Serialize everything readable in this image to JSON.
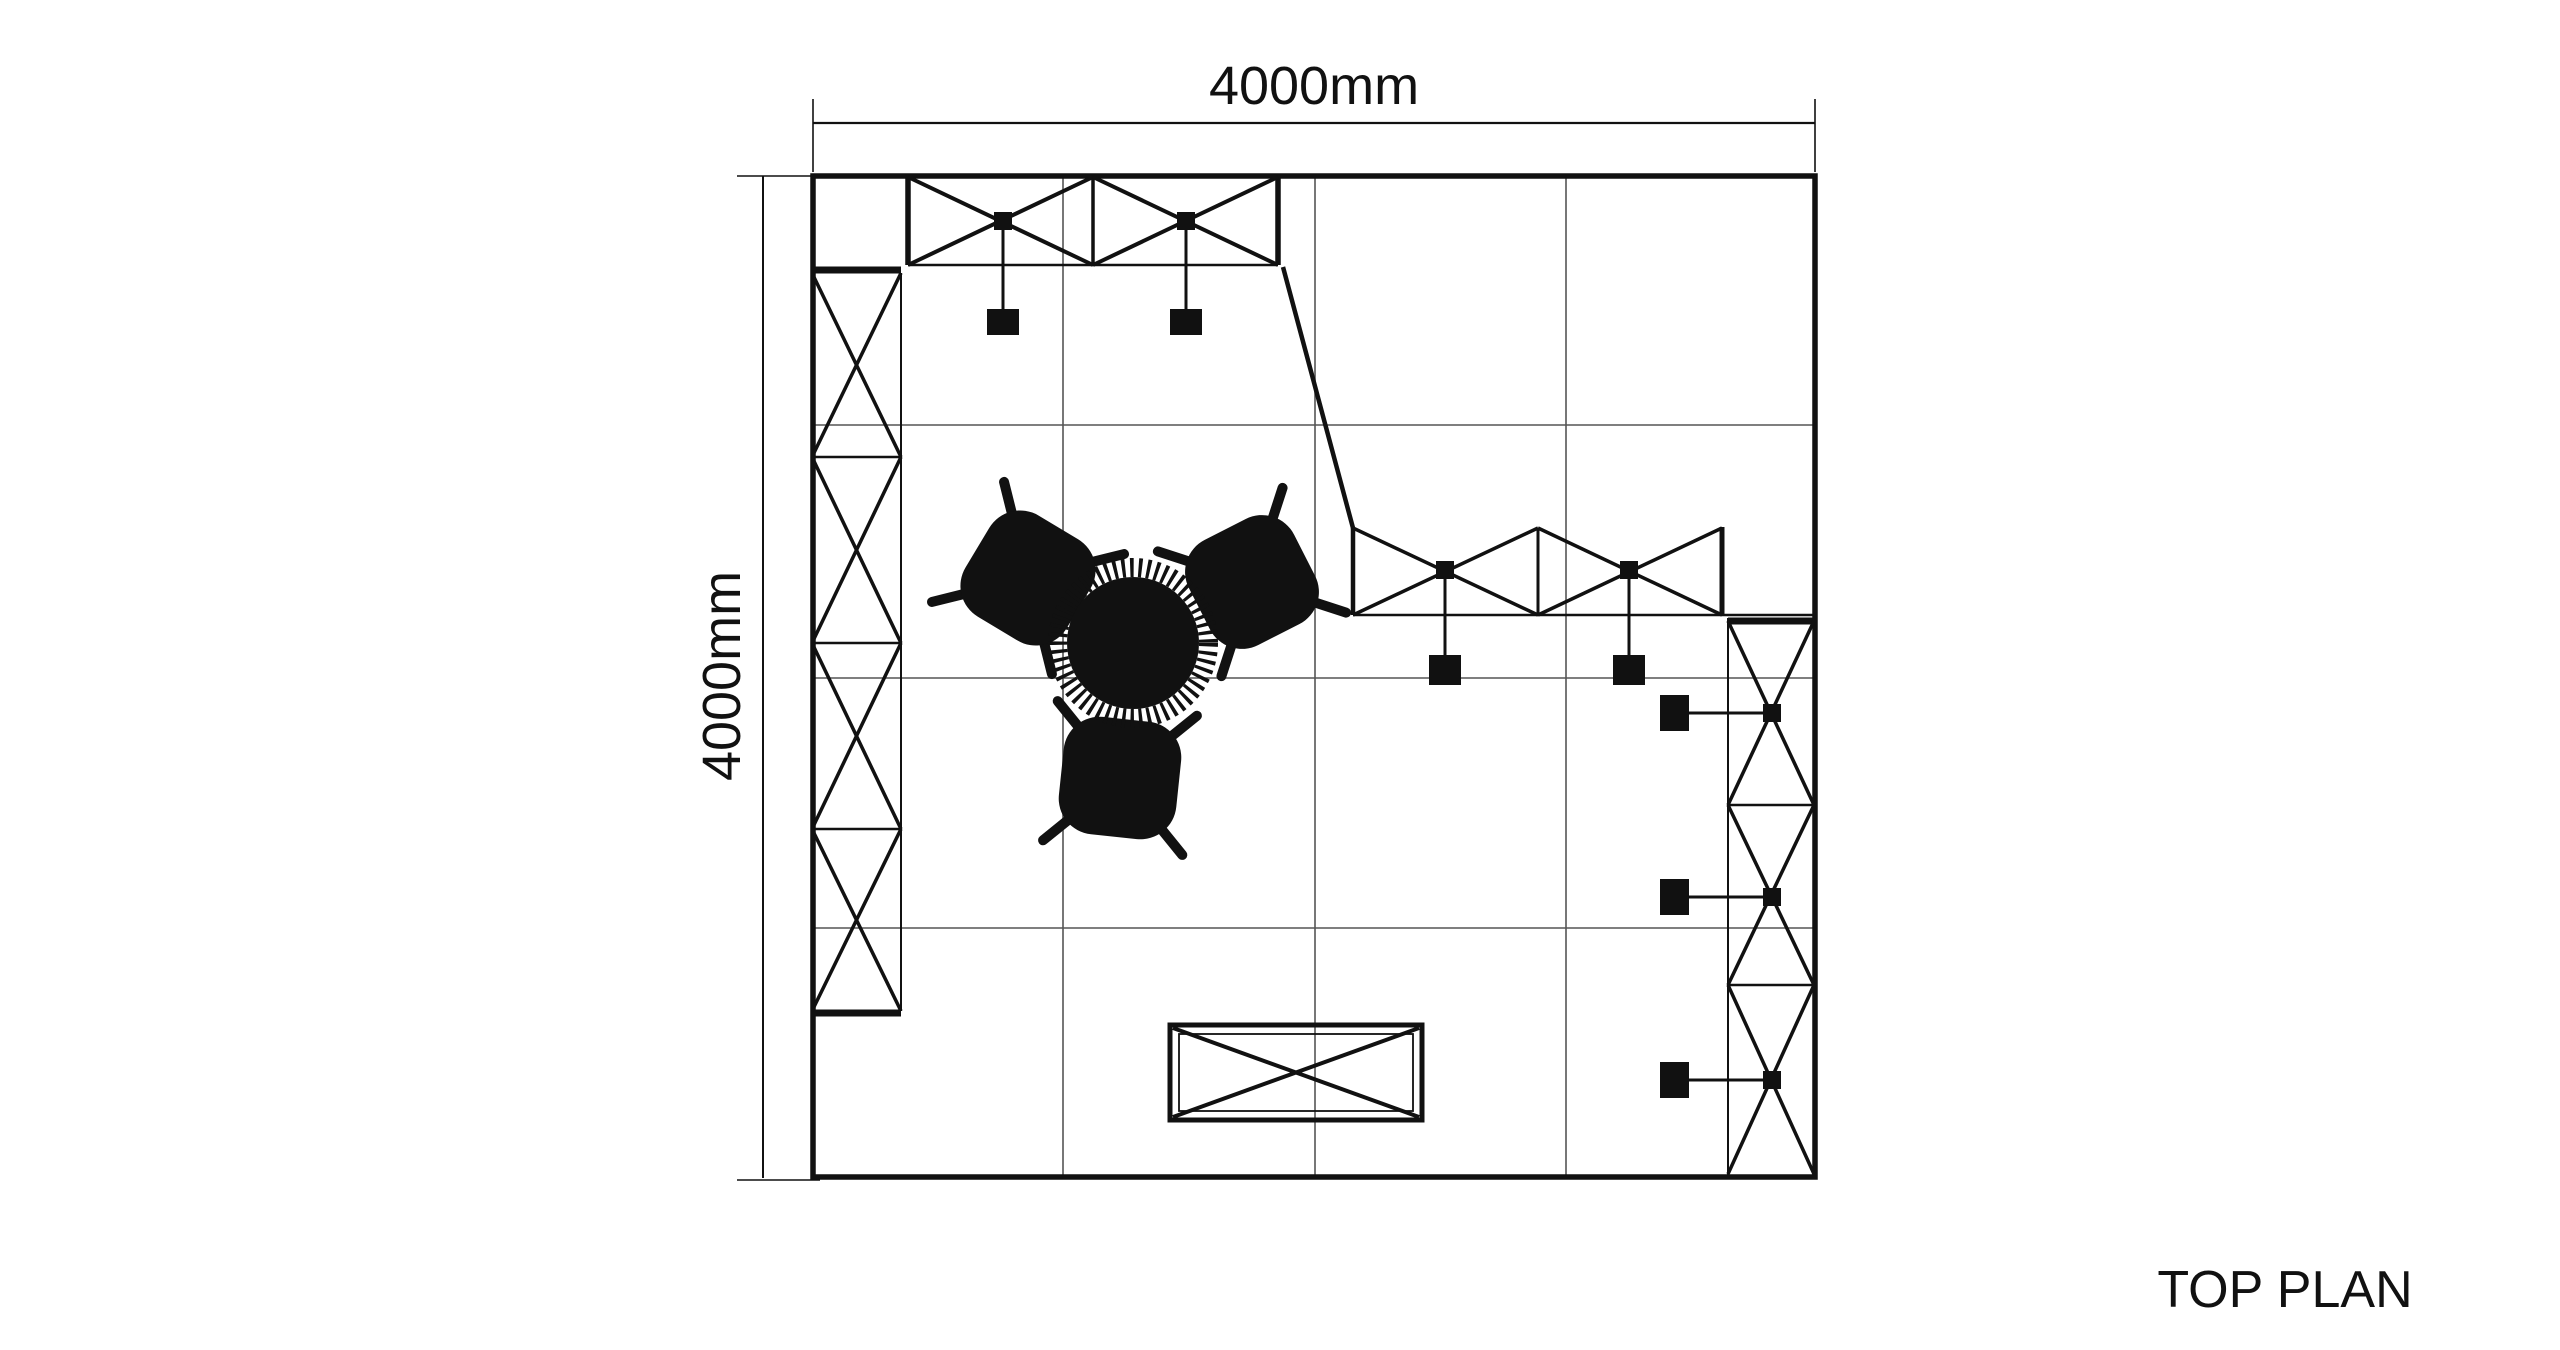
{
  "title": "TOP PLAN",
  "dimensions": {
    "top": "4000mm",
    "left": "4000mm"
  },
  "colors": {
    "ink": "#111111",
    "grid_line": "#555555",
    "background": "#ffffff"
  },
  "plan": {
    "booth_width_label": "4000mm",
    "booth_depth_label": "4000mm",
    "element_counts": {
      "ceiling_trusses": 2,
      "wall_trusses": 2,
      "spotlights": 7,
      "truss_nodes": 7,
      "chairs": 3,
      "round_tables": 1,
      "counters": 1
    }
  }
}
